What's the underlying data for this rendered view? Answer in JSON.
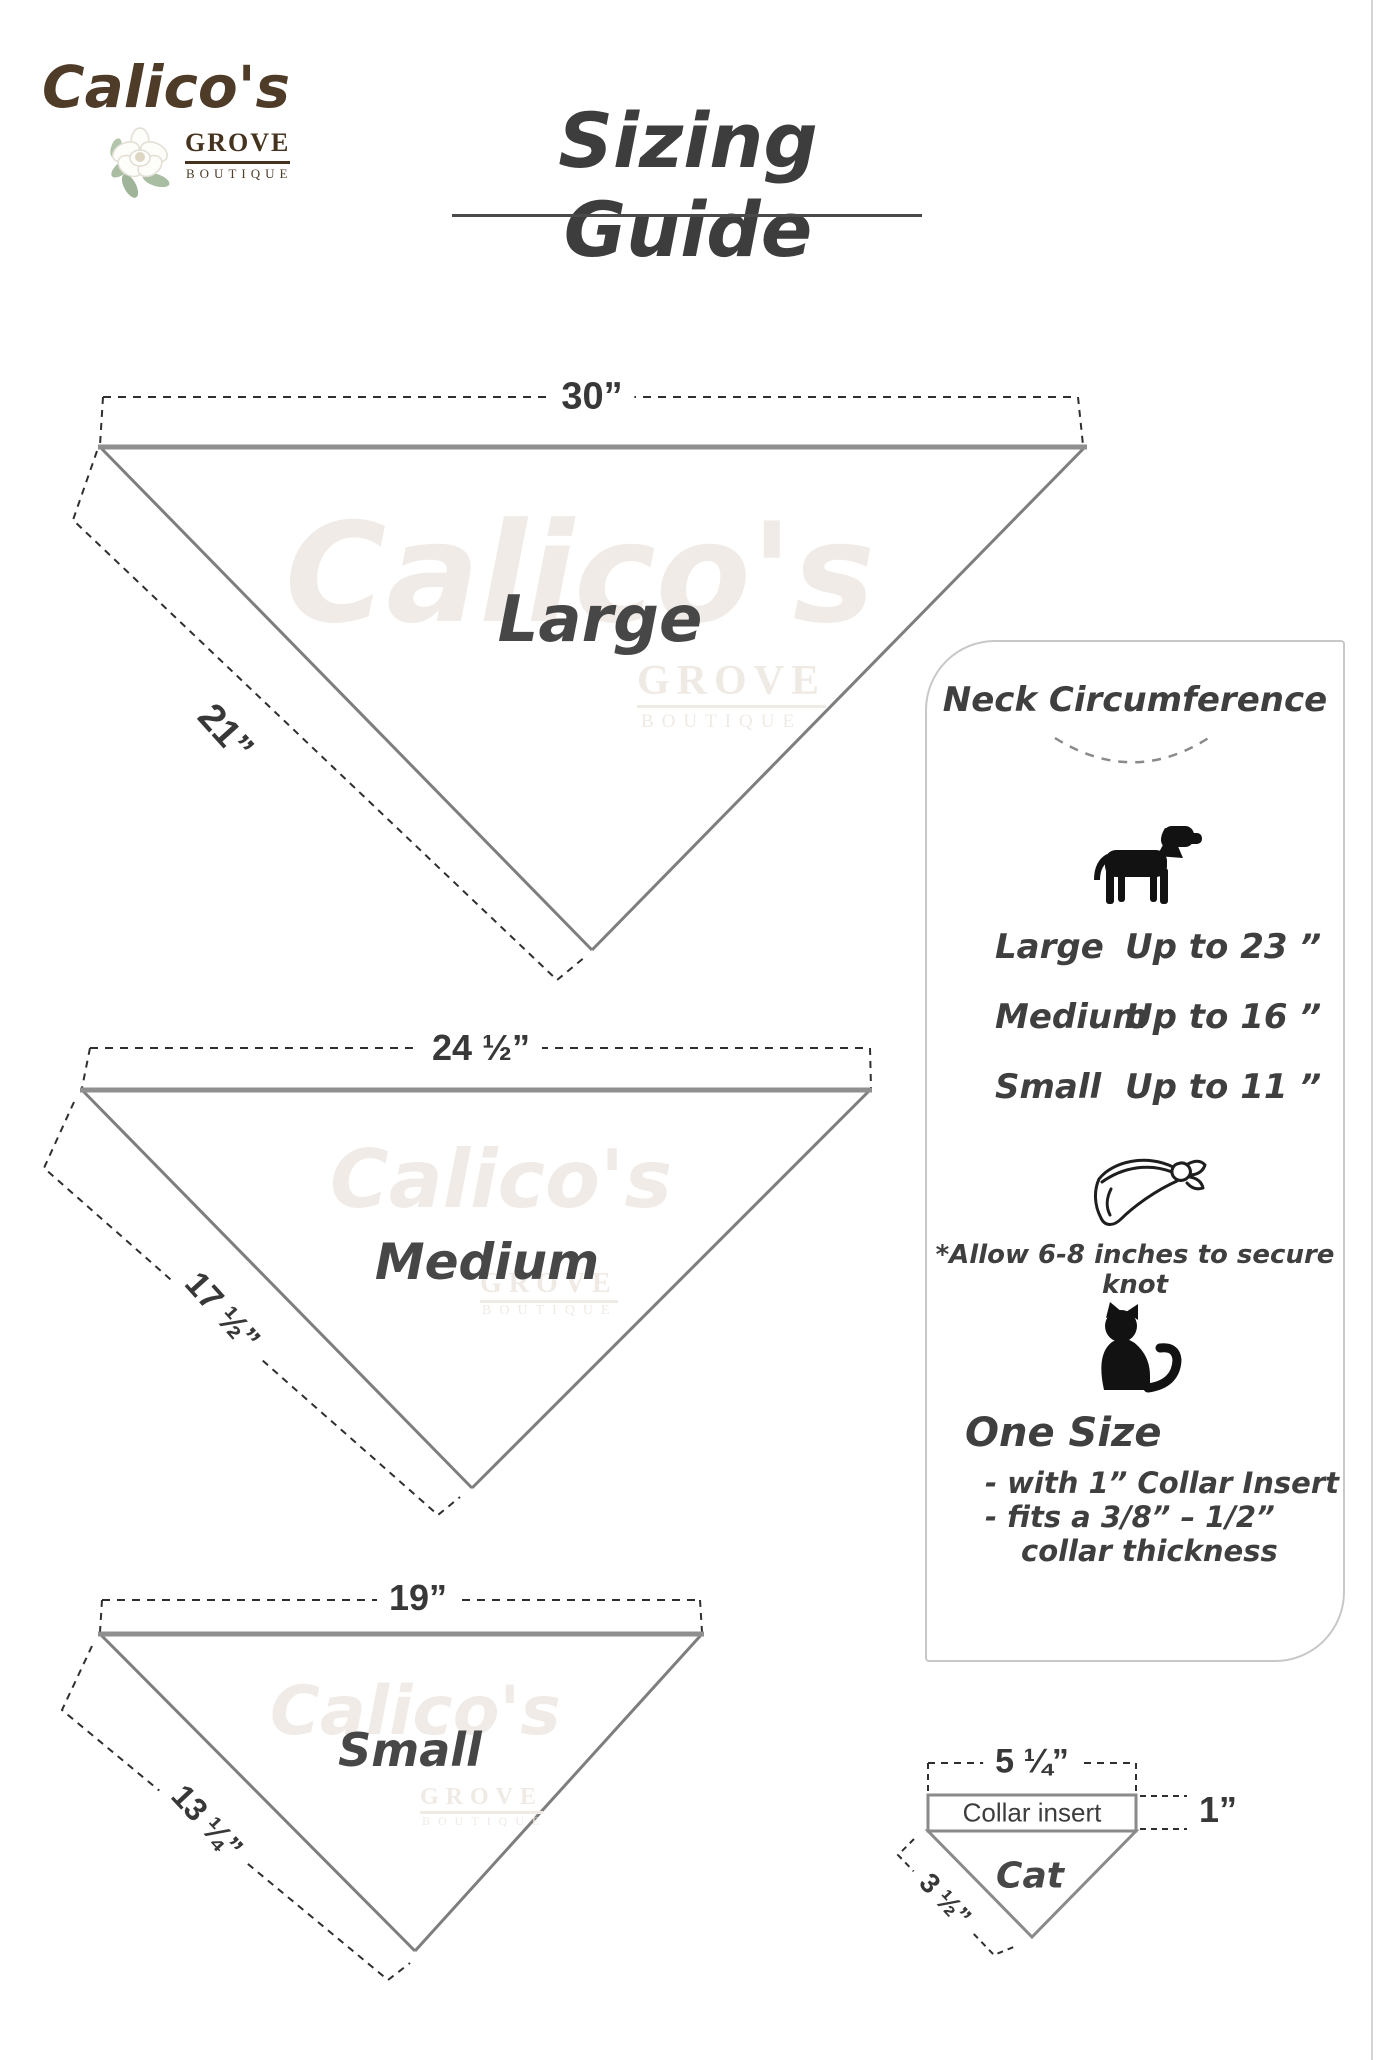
{
  "logo": {
    "brand": "Calico's",
    "grove": "GROVE",
    "boutique": "BOUTIQUE"
  },
  "title": "Sizing Guide",
  "watermark": {
    "brand": "Calico's",
    "grove": "GROVE",
    "boutique": "BOUTIQUE"
  },
  "triangles": [
    {
      "name": "Large",
      "top_width": "30”",
      "side_length": "21”"
    },
    {
      "name": "Medium",
      "top_width": "24 ½”",
      "side_length": "17 ½”"
    },
    {
      "name": "Small",
      "top_width": "19”",
      "side_length": "13 ¼”"
    }
  ],
  "panel": {
    "heading": "Neck Circumference",
    "dog_icon": "dog-silhouette",
    "sizes": [
      {
        "label": "Large",
        "value": "Up to 23 ”"
      },
      {
        "label": "Medium",
        "value": "Up to 16 ”"
      },
      {
        "label": "Small",
        "value": "Up to 11 ”"
      }
    ],
    "bandana_icon": "tied-bandana",
    "knot_note": "*Allow 6-8 inches to secure knot",
    "cat_icon": "cat-silhouette",
    "one_size": {
      "heading": "One Size",
      "line1": "- with 1” Collar Insert",
      "line2": "- fits a 3/8” – 1/2”",
      "line3": "collar thickness"
    }
  },
  "cat_diagram": {
    "top_width": "5 ¼”",
    "insert_label": "Collar insert",
    "insert_height": "1”",
    "name": "Cat",
    "side_length": "3 ½”"
  },
  "colors": {
    "logo_brown": "#4e3b28",
    "text_dark": "#3d3d3d",
    "triangle_gray": "#7e7e7e",
    "panel_border": "#c8c8c8",
    "watermark": "#f1ebe7"
  }
}
